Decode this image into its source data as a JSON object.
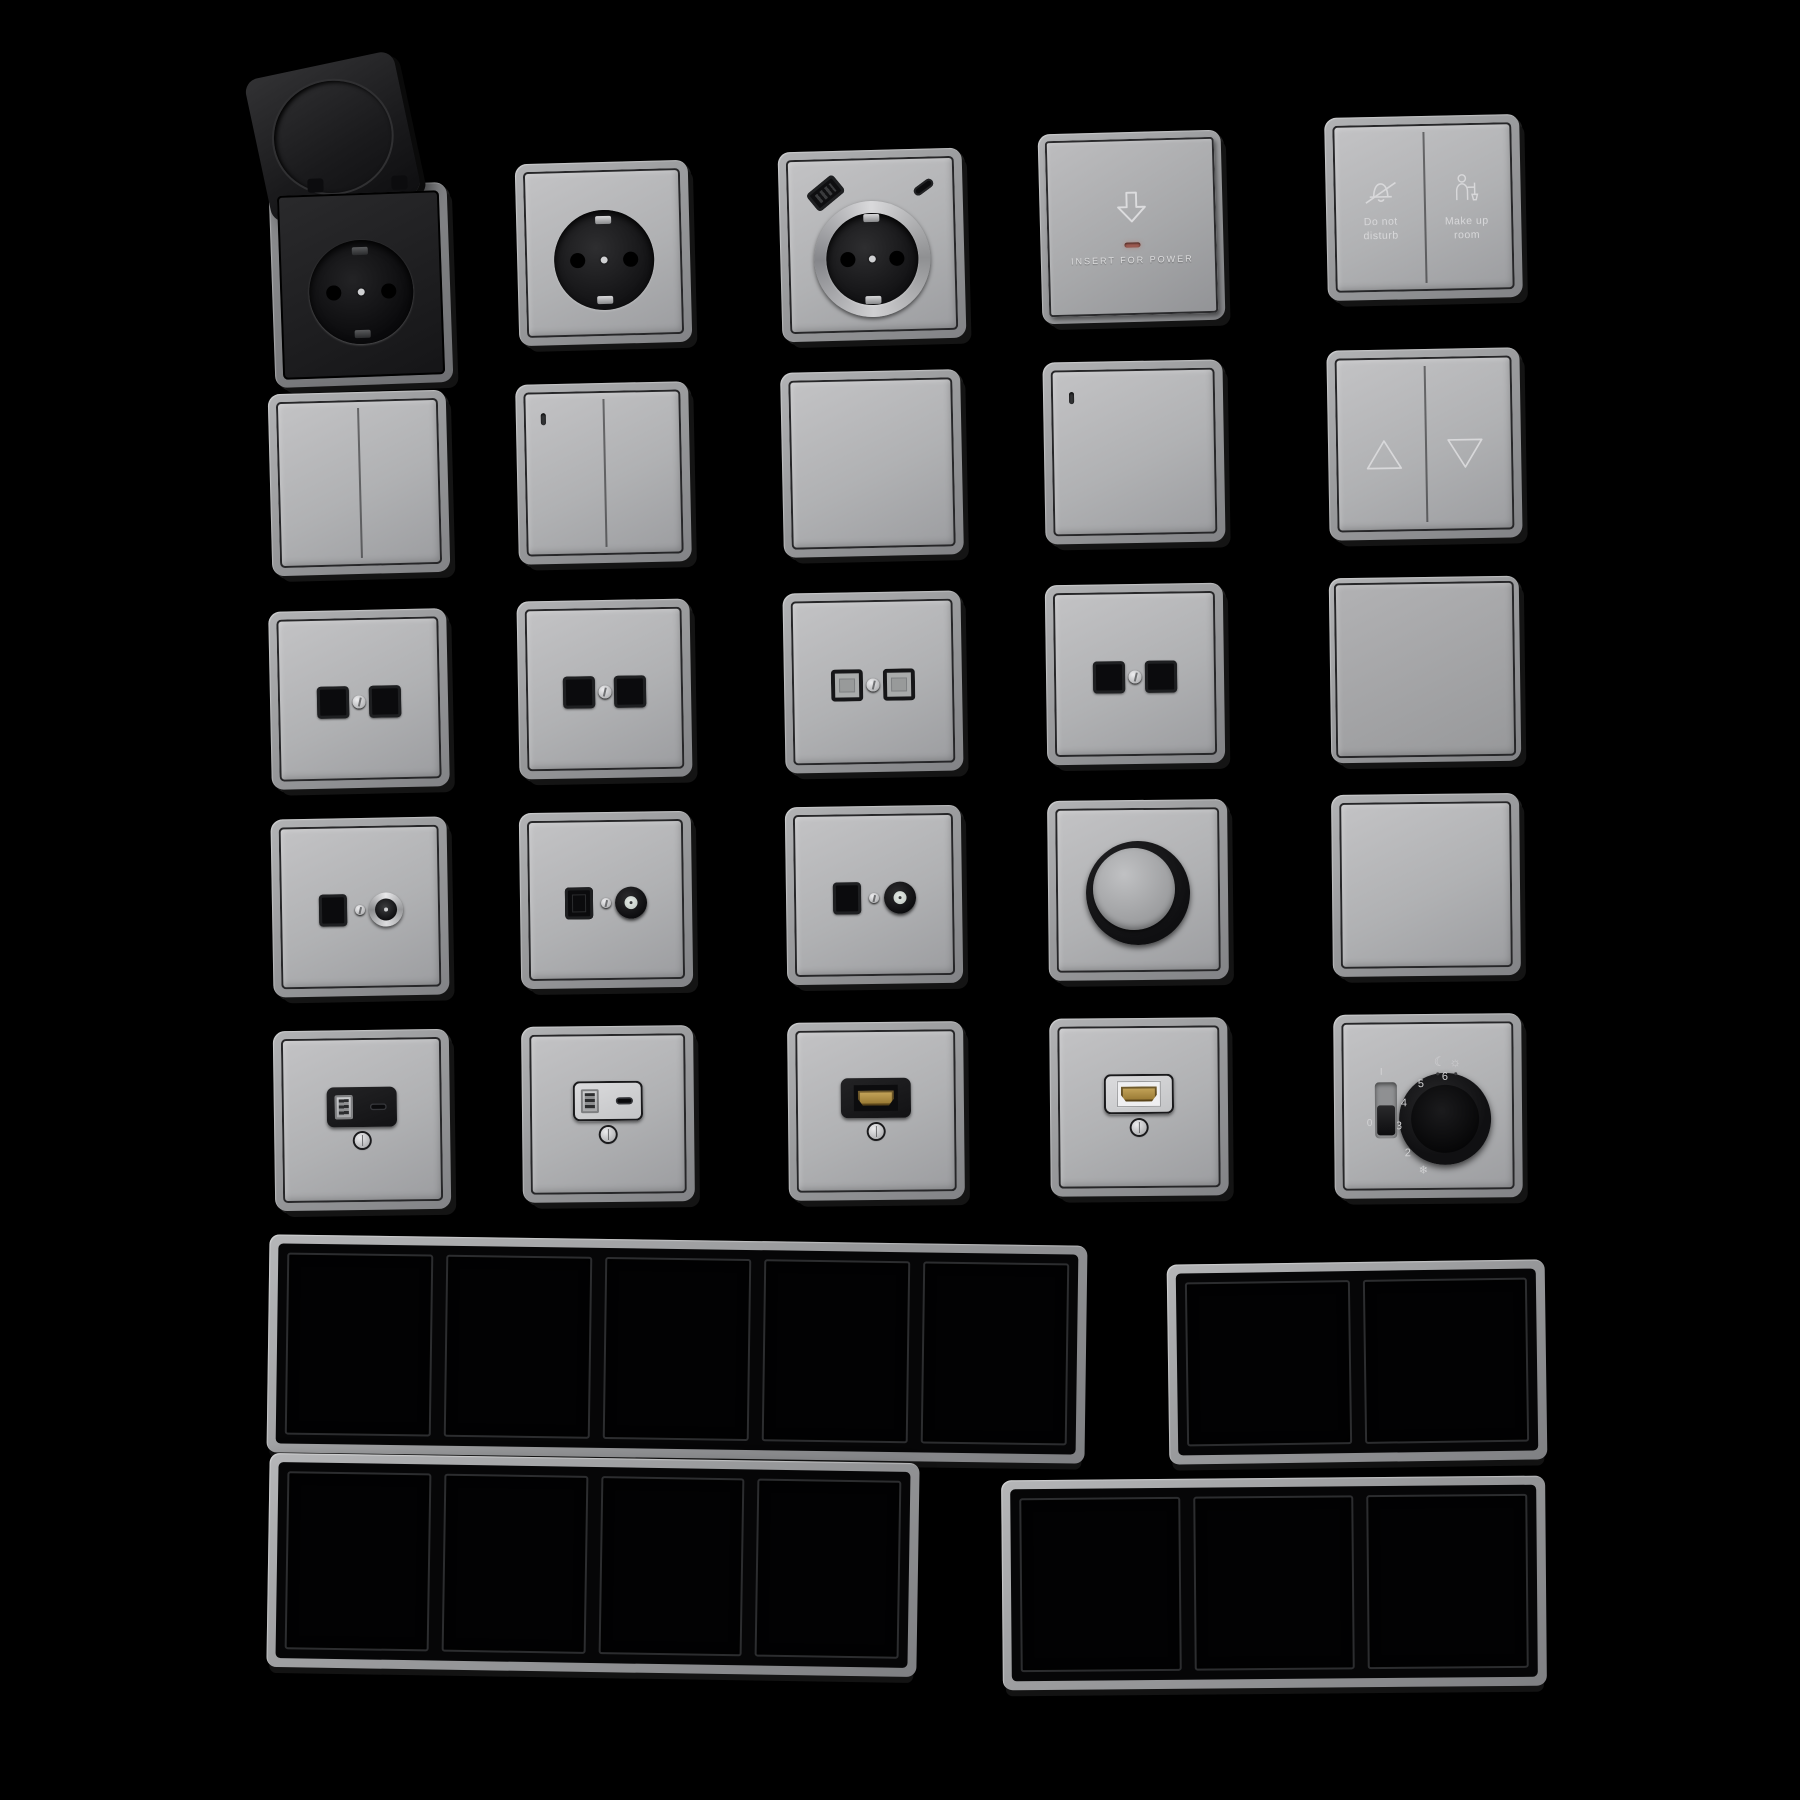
{
  "scene": {
    "background": "#000000",
    "plate_face_color": "#b0b1b3",
    "metal_frame_color": "#97989a",
    "black_insert_color": "#141416",
    "light_insert_color": "#d6d6d8",
    "hdmi_gold_color": "#b3924d",
    "led_red_color": "#9e5c52",
    "engraving_color": "#d8d8da"
  },
  "collection": {
    "rows": 5,
    "cols": 5,
    "items": [
      {
        "row": 1,
        "col": 1,
        "name": "socket-flip-cover",
        "type": "schuko socket with open black flip lid"
      },
      {
        "row": 1,
        "col": 2,
        "name": "socket-schuko",
        "type": "schuko socket"
      },
      {
        "row": 1,
        "col": 3,
        "name": "socket-schuko-usb",
        "type": "schuko socket with USB-A and USB-C"
      },
      {
        "row": 1,
        "col": 4,
        "name": "key-card-switch",
        "type": "hotel key card power switch"
      },
      {
        "row": 1,
        "col": 5,
        "name": "service-switch",
        "type": "do-not-disturb / make-up-room switch"
      },
      {
        "row": 2,
        "col": 1,
        "name": "double-rocker-switch",
        "type": "2-gang rocker"
      },
      {
        "row": 2,
        "col": 2,
        "name": "double-rocker-switch-led",
        "type": "2-gang rocker with indicator"
      },
      {
        "row": 2,
        "col": 3,
        "name": "single-rocker-switch",
        "type": "1-gang rocker"
      },
      {
        "row": 2,
        "col": 4,
        "name": "single-rocker-switch-led",
        "type": "1-gang rocker with indicator"
      },
      {
        "row": 2,
        "col": 5,
        "name": "shutter-switch",
        "type": "blind switch with up/down arrows"
      },
      {
        "row": 3,
        "col": 1,
        "name": "data-socket-double",
        "type": "twin black data jacks"
      },
      {
        "row": 3,
        "col": 2,
        "name": "data-socket-double-2",
        "type": "twin black data jacks"
      },
      {
        "row": 3,
        "col": 3,
        "name": "data-socket-double-shuttered",
        "type": "twin shuttered data jacks"
      },
      {
        "row": 3,
        "col": 4,
        "name": "data-socket-double-3",
        "type": "twin black data jacks"
      },
      {
        "row": 3,
        "col": 5,
        "name": "large-rocker-switch",
        "type": "full-face rocker"
      },
      {
        "row": 4,
        "col": 1,
        "name": "tv-data-socket-coax",
        "type": "data jack with silver coax connector"
      },
      {
        "row": 4,
        "col": 2,
        "name": "tv-data-socket-2",
        "type": "data jack with round antenna connector"
      },
      {
        "row": 4,
        "col": 3,
        "name": "tv-data-socket-3",
        "type": "data jack with round antenna connector"
      },
      {
        "row": 4,
        "col": 4,
        "name": "rotary-dimmer",
        "type": "rotary dimmer knob"
      },
      {
        "row": 4,
        "col": 5,
        "name": "blank-plate",
        "type": "blank cover plate"
      },
      {
        "row": 5,
        "col": 1,
        "name": "usb-charger-socket-black",
        "type": "USB-A/USB-C charger, black insert"
      },
      {
        "row": 5,
        "col": 2,
        "name": "usb-charger-socket-light",
        "type": "USB-A/USB-C charger, light insert"
      },
      {
        "row": 5,
        "col": 3,
        "name": "hdmi-socket-black",
        "type": "HDMI outlet, black insert"
      },
      {
        "row": 5,
        "col": 4,
        "name": "hdmi-socket-light",
        "type": "HDMI outlet, light insert"
      },
      {
        "row": 5,
        "col": 5,
        "name": "thermostat-dial",
        "type": "thermostat with dial and slider"
      }
    ]
  },
  "card_switch": {
    "label": "INSERT FOR POWER"
  },
  "service_switch": {
    "left_label": "Do not\ndisturb",
    "right_label": "Make up\nroom"
  },
  "thermostat": {
    "scale": [
      "2",
      "3",
      "4",
      "5",
      "6"
    ],
    "snowflake": "❄",
    "moon": "☾",
    "sun": "☼",
    "on": "I",
    "off": "0"
  },
  "icons": {
    "bell_crossed": "do-not-disturb-bell-icon",
    "maid": "make-up-room-icon",
    "arrow_down": "insert-card-arrow-icon",
    "triangle_up": "shutter-up-icon",
    "triangle_down": "shutter-down-icon"
  },
  "frames": {
    "items": [
      {
        "name": "frame-5-gang",
        "gangs": 5
      },
      {
        "name": "frame-2-gang",
        "gangs": 2
      },
      {
        "name": "frame-4-gang",
        "gangs": 4
      },
      {
        "name": "frame-3-gang",
        "gangs": 3
      }
    ]
  }
}
